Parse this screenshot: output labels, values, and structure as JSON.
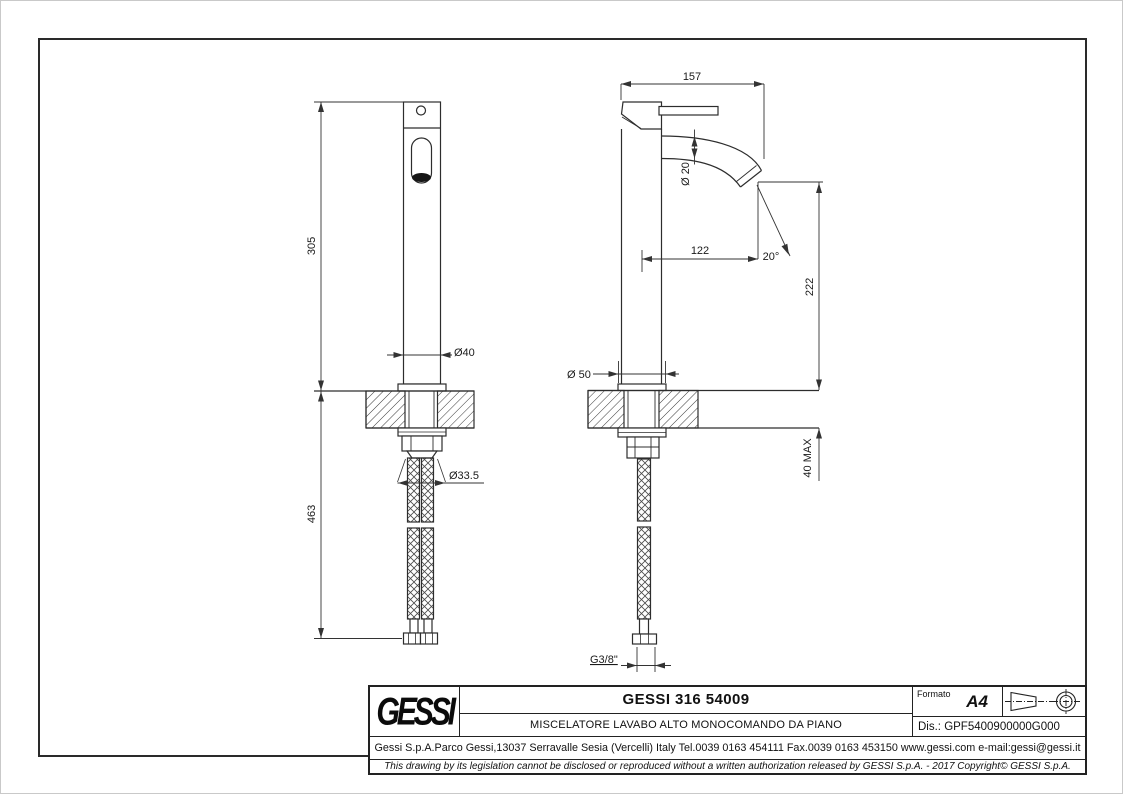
{
  "drawing": {
    "front_view": {
      "dim_body_height": "305",
      "dim_hose_length": "463",
      "dim_body_diameter": "Ø40",
      "dim_shank_diameter": "Ø33.5"
    },
    "side_view": {
      "dim_overall_depth": "157",
      "dim_spout_diameter": "Ø 20",
      "dim_spout_reach": "122",
      "dim_stream_angle": "20°",
      "dim_spout_height": "222",
      "dim_base_diameter": "Ø 50",
      "dim_deck_thickness": "40 MAX",
      "dim_hose_thread": "G3/8\""
    }
  },
  "title_block": {
    "logo": "GESSI",
    "product_code": "GESSI 316 54009",
    "product_description": "MISCELATORE LAVABO ALTO MONOCOMANDO DA PIANO",
    "formato_label": "Formato",
    "formato_value": "A4",
    "drawing_number": "Dis.: GPF5400900000G000",
    "company_info": "Gessi S.p.A.Parco Gessi,13037 Serravalle Sesia (Vercelli) Italy Tel.0039 0163 454111 Fax.0039 0163 453150 www.gessi.com e-mail:gessi@gessi.it",
    "disclaimer": "This drawing by its legislation cannot be disclosed or reproduced without a written authorization released by GESSI S.p.A. - 2017 Copyright© GESSI S.p.A."
  }
}
